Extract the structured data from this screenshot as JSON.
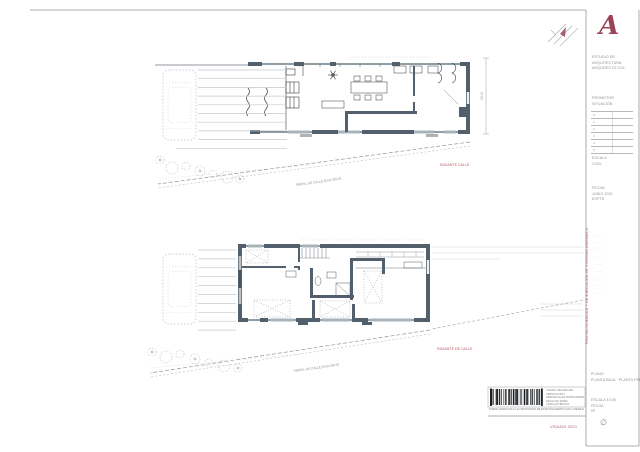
{
  "titleblock": {
    "logo_letter": "A",
    "studio_lines": [
      "ESTUDIO DE",
      "ARQUITECTURA",
      "ARQUITECTO COL."
    ],
    "promoter_lines": [
      "PROMOTOR",
      "SITUACIÓN"
    ],
    "revision_rows": [
      "0 ·",
      "1 ·",
      "2 ·",
      "3 ·",
      "4 ·",
      "5 ·"
    ],
    "scale_lines": [
      "ESCALA",
      "1/100"
    ],
    "date_lines": [
      "FECHA",
      "JUNIO 2021",
      "EXPTE."
    ],
    "coord_rows": [
      "·· ·····",
      "·· ·····",
      "·· ·····",
      "·· ·····",
      "·· ·····",
      "·· ·····",
      "·· ·····",
      "·· ·····",
      "·· ·····"
    ],
    "project_title_vertical": "PROYECTO BÁSICO Y DE EJECUCIÓN DE VIVIENDA UNIFAMILIAR",
    "plan_lines": [
      "PLANO",
      "PLANTA BAJA · PLANTA PRIMERA"
    ],
    "sheet_lines": [
      "ESCALA 1/100",
      "FECHA",
      "Nº"
    ],
    "diameter_mark": "∅",
    "visado_text": "VISADO 2021"
  },
  "annotations": {
    "upper_red_note": "RASANTE CALLE",
    "upper_slope_label": "PERFIL DE CALLE EXISTENTE",
    "upper_dim_text": "28.40",
    "lower_red_note": "RASANTE DE CALLE",
    "lower_slope_label": "PERFIL DE CALLE EXISTENTE"
  },
  "stamp": {
    "side_lines": [
      "CÓDIGO SEGURO DE",
      "VERIFICACIÓN",
      "FIRMADO ELECTRÓNICAMENTE",
      "FECHA DE FIRMA",
      "COPIA AUTÉNTICA"
    ],
    "footer_line": "PUEDE VERIFICAR LA AUTENTICIDAD DE ESTE DOCUMENTO EN LA SEDE ELECTRÓNICA"
  },
  "colors": {
    "wall": "#51606c",
    "accent_red": "#b55965",
    "logo_red": "#9c4255",
    "line_light": "#c3c8cd",
    "line_mid": "#9aa0a6",
    "text_gray": "#8a8f94"
  }
}
